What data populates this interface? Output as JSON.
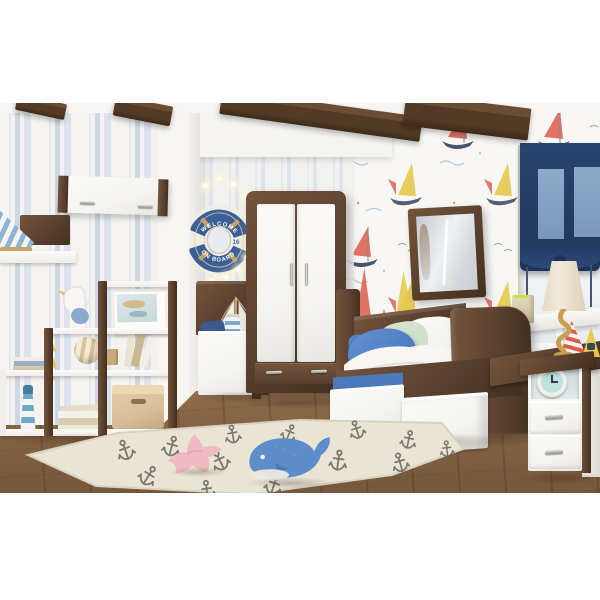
{
  "image": {
    "kind": "product-photograph",
    "subject": "nautical kids bedroom furniture set in walnut and white"
  },
  "lifebuoy": {
    "top_text": "WELCOME",
    "bottom_text": "ON BOARD",
    "badge": "16"
  },
  "palette": {
    "walnut": "#5a4030",
    "walnut_dark": "#43301e",
    "walnut_light": "#73543a",
    "white_furniture": "#f5f4f0",
    "wall_white": "#f5f4f1",
    "wallpaper_bg": "#f8f7f4",
    "navy_blind": "#2a4470",
    "navy_blind_dark": "#1f3557",
    "pane_blue": "#8fa9c9",
    "bed_blue": "#4a7abc",
    "pillow_blue": "#4e7ec4",
    "green_pillow": "#ccdcc4",
    "duvet_white": "#f7f6f3",
    "floor_light": "#9d7c5e",
    "floor_dark": "#74563c",
    "rug_cream": "#eae4d5",
    "anchor_gray": "#5d5d55",
    "whale_blue": "#5d8eca",
    "whale_fin": "#4a7ab2",
    "starfish_pink": "#f0bac4",
    "buoy_blue": "#3c5f94",
    "buoy_white": "#f0ede4",
    "rope_tan": "#c8a368",
    "lamp_gold": "#c9a052",
    "lamp_shade": "#f1e9d8",
    "basket_beige": "#d9c09a",
    "sail_red": "#dd5b4c",
    "sail_yellow": "#e6c94e",
    "hull_navy": "#33455f",
    "clock_teal": "#bfe2de",
    "seagull_wing": "#7fa3c8"
  }
}
